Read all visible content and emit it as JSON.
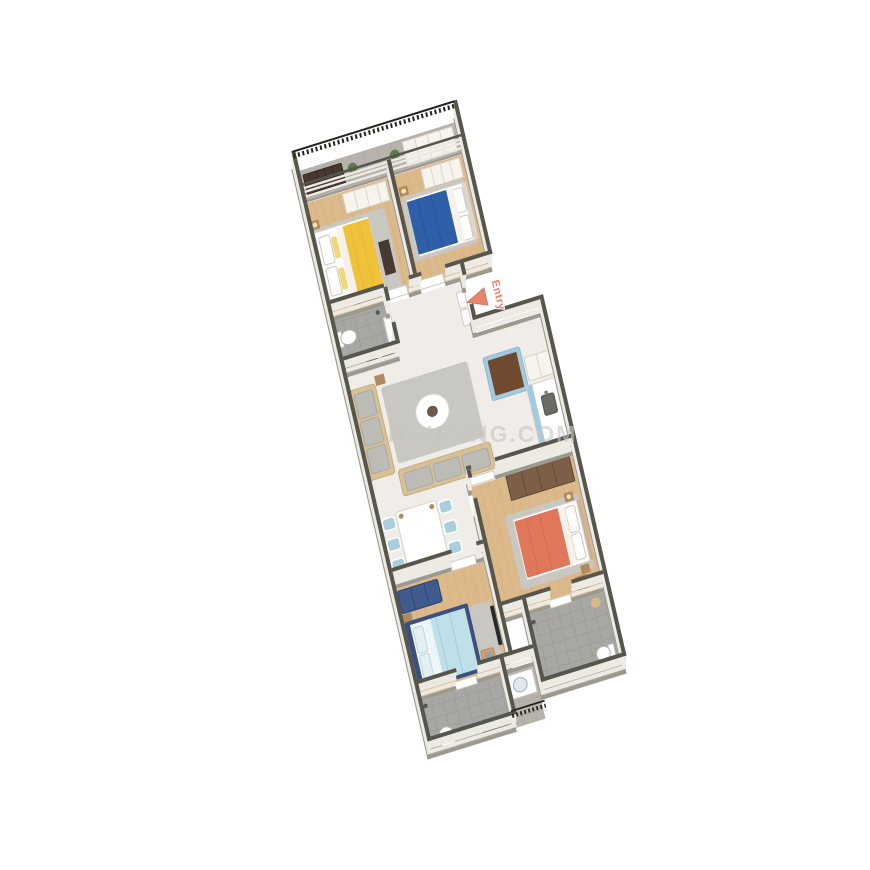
{
  "labels": {
    "entry": "Entry",
    "watermark": "HOUSING.COM"
  },
  "colors": {
    "wall": "#57564c",
    "wall_face": "#eceae3",
    "wall_base": "#9c998f",
    "wood_floor": "#dcb98b",
    "tile_gray": "#a8a7a3",
    "balcony_floor": "#b7b3ac",
    "tile_light": "#f0ede8",
    "rug": "#c9c7c1",
    "bed_yellow": "#f0c23c",
    "bed_blue": "#2e5fa7",
    "bed_lightblue": "#bfe0e8",
    "bed_navy": "#3b5080",
    "bed_orange": "#e0765a",
    "sofa": "#d8c096",
    "cushion": "#bcbbb6",
    "chair_blue": "#a9cfdd",
    "kitchen_blue": "#a3cbe0",
    "counter_brown": "#6f4a2f",
    "wardrobe_brown": "#7d5f48",
    "bench_navy": "#3f5a8f",
    "wood_furniture": "#b08a5e",
    "dark_furniture": "#473931",
    "vanity_brown": "#6f5a45",
    "fixture_white": "#ffffff",
    "entry_arrow": "#e8836f",
    "plant": "#5a7a4a",
    "railing": "#24241f"
  },
  "scene": {
    "type": "3d-isometric-floor-plan",
    "rooms": [
      "balcony",
      "bedroom-yellow",
      "bedroom-blue",
      "bathroom-1",
      "entry-foyer",
      "living-room",
      "kitchen",
      "dining-area",
      "bedroom-orange",
      "bedroom-lightblue",
      "bathroom-2",
      "bathroom-3",
      "utility-deck"
    ],
    "furniture": [
      "balcony-railing",
      "plants",
      "wardrobes",
      "double-bed-yellow",
      "double-bed-blue",
      "double-bed-lightblue",
      "double-bed-orange",
      "tv-stands",
      "sofa-set",
      "coffee-table",
      "area-rugs",
      "kitchen-island",
      "kitchen-counter-with-sink",
      "tall-cabinet",
      "dining-table-six-chairs",
      "brown-wardrobe",
      "navy-bench",
      "bedside-tables",
      "study-chairs-with-laptops",
      "toilets",
      "washbasins",
      "vanities",
      "shower-heads",
      "washing-machine",
      "door-leaves",
      "utility-railing"
    ]
  }
}
